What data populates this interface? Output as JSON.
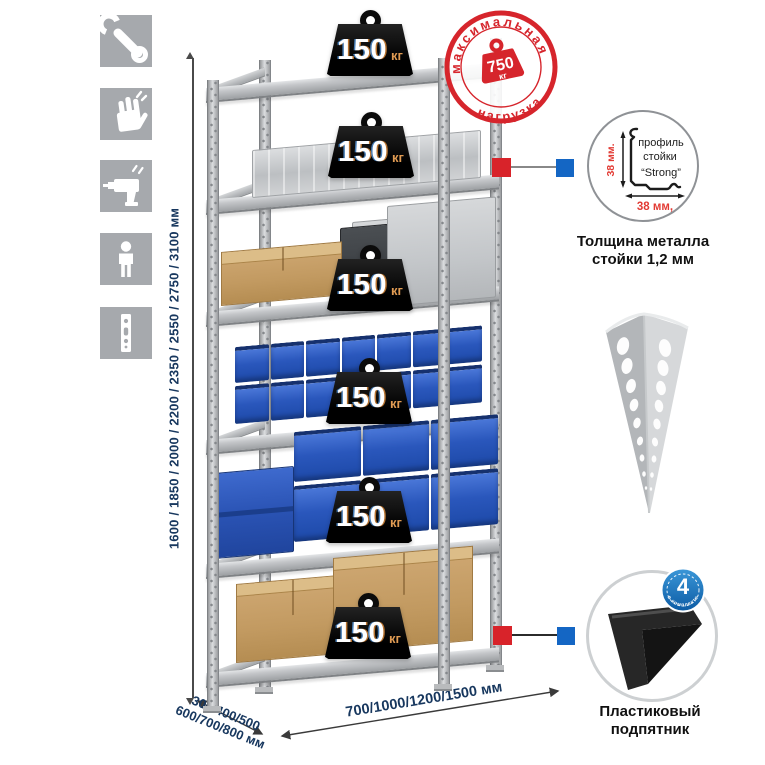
{
  "sidebar_icons": [
    {
      "name": "wrench-icon"
    },
    {
      "name": "gloves-icon"
    },
    {
      "name": "drill-icon"
    },
    {
      "name": "person-icon"
    },
    {
      "name": "post-profile-icon"
    }
  ],
  "rack": {
    "shelf_count": 6,
    "shelf_load": {
      "value": "150",
      "unit": "кг"
    }
  },
  "stamp": {
    "arc_top": "максимальная",
    "arc_bottom": "нагрузка",
    "value": "750",
    "unit": "кг"
  },
  "dimensions": {
    "height": "1600 / 1850 / 2000 / 2200 / 2350 / 2550 / 2750 / 3100 мм",
    "depth_line1": "300/400/500",
    "depth_line2": "600/700/800 мм",
    "width": "700/1000/1200/1500 мм"
  },
  "profile_detail": {
    "label_line1": "профиль",
    "label_line2": "стойки",
    "label_line3": "“Strong”",
    "dim_vertical": "38 мм.",
    "dim_horizontal": "38 мм,",
    "caption_line1": "Толщина металла",
    "caption_line2": "стойки 1,2 мм"
  },
  "foot_detail": {
    "badge_value": "4",
    "badge_ring_text": "в комплекте",
    "caption_line1": "Пластиковый",
    "caption_line2": "подпятник"
  },
  "colors": {
    "accent_red": "#d6252c",
    "connector_blue": "#1466c4",
    "dim_text": "#17375e"
  }
}
